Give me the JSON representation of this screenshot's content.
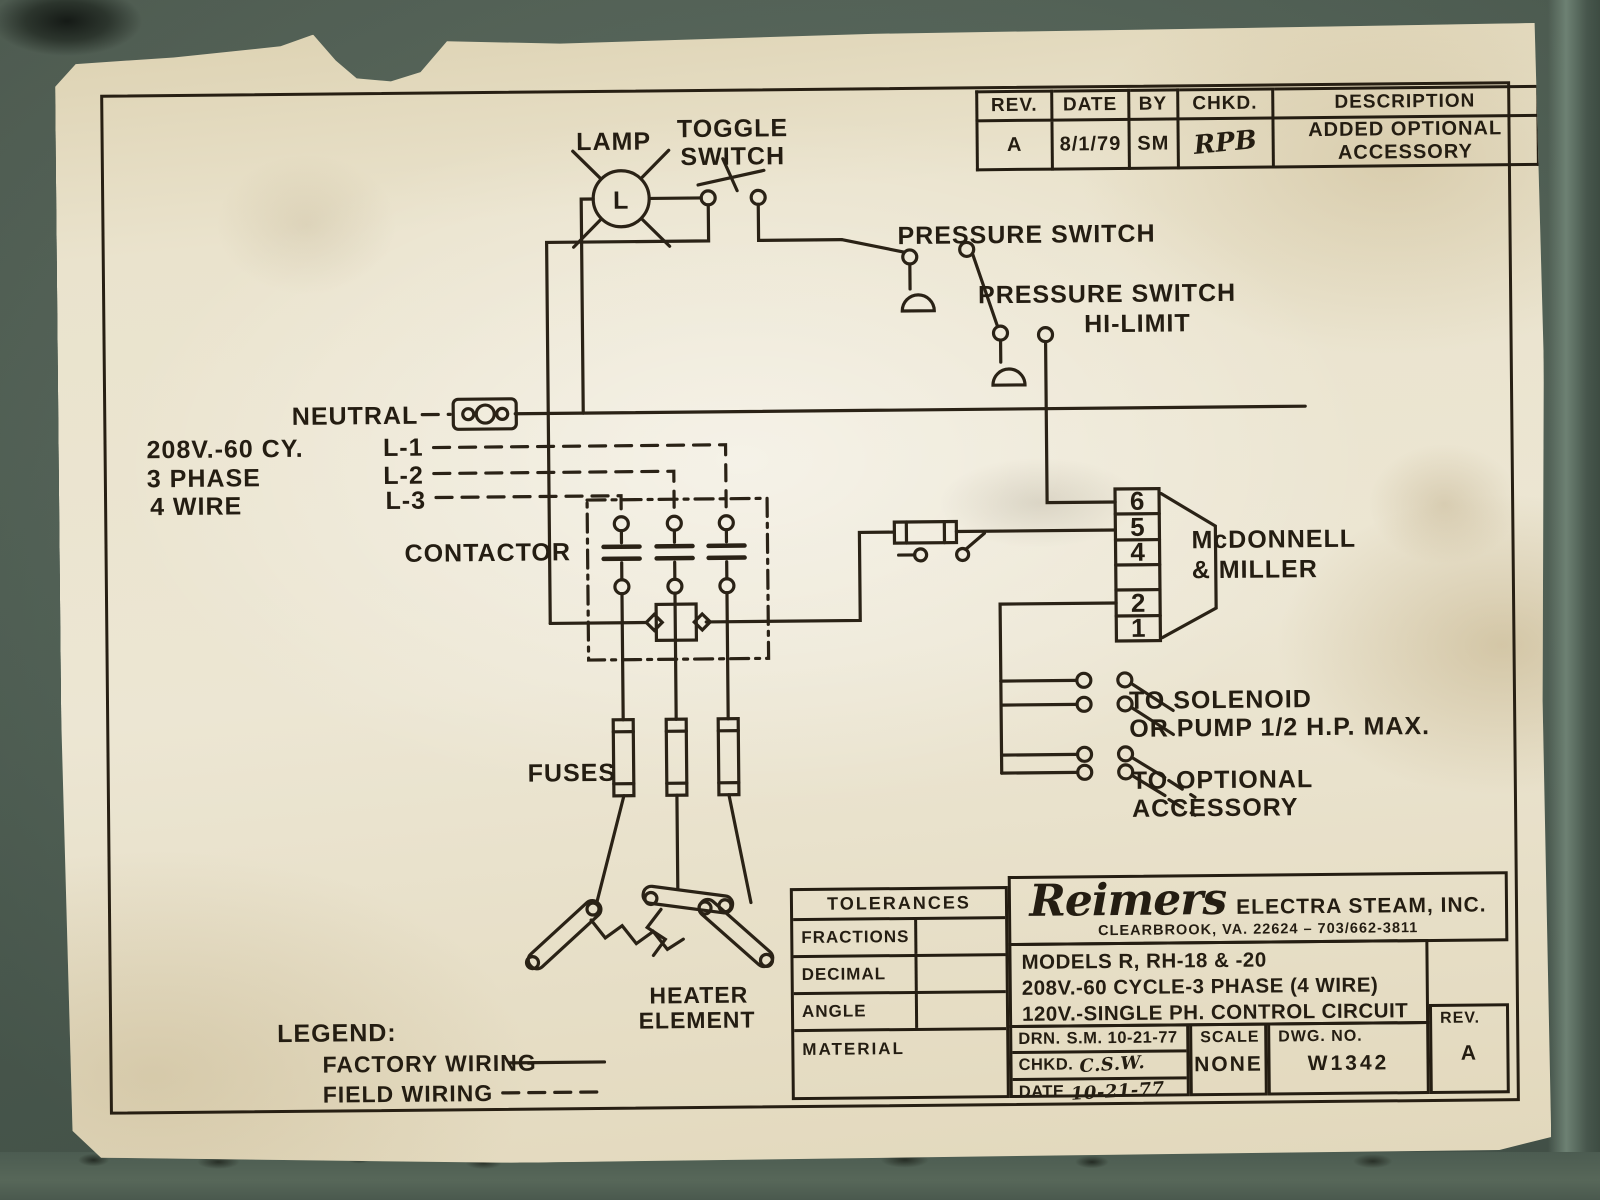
{
  "colors": {
    "background_metal": "#586a5d",
    "paper": "#eae3cd",
    "ink": "#2a2216"
  },
  "revision_table": {
    "headers": [
      "REV.",
      "DATE",
      "BY",
      "CHKD.",
      "DESCRIPTION"
    ],
    "row": {
      "rev": "A",
      "date": "8/1/79",
      "by": "SM",
      "chkd": "RPB",
      "description": "ADDED  OPTIONAL  ACCESSORY"
    }
  },
  "schematic": {
    "lamp_label": "LAMP",
    "lamp_symbol": "L",
    "toggle_switch_line1": "TOGGLE",
    "toggle_switch_line2": "SWITCH",
    "pressure_switch_label": "PRESSURE SWITCH",
    "hi_limit_line1": "PRESSURE SWITCH",
    "hi_limit_line2": "HI-LIMIT",
    "neutral_label": "NEUTRAL",
    "supply_line1": "208V.-60 CY.",
    "supply_line2": "3 PHASE",
    "supply_line3": "4 WIRE",
    "l1_label": "L-1",
    "l2_label": "L-2",
    "l3_label": "L-3",
    "contactor_label": "CONTACTOR",
    "terminal_strip_name_line1": "McDONNELL",
    "terminal_strip_name_line2": "& MILLER",
    "terminal_numbers": [
      "6",
      "5",
      "4",
      "",
      "2",
      "1"
    ],
    "solenoid_line1": "TO SOLENOID",
    "solenoid_line2": "OR PUMP 1/2 H.P. MAX.",
    "accessory_line1": "TO OPTIONAL",
    "accessory_line2": "ACCESSORY",
    "fuses_label": "FUSES",
    "heater_line1": "HEATER",
    "heater_line2": "ELEMENT"
  },
  "legend": {
    "title": "LEGEND:",
    "factory": "FACTORY WIRING",
    "field": "FIELD WIRING"
  },
  "title_block": {
    "tolerances_header": "TOLERANCES",
    "tolerance_rows": [
      "FRACTIONS",
      "DECIMAL",
      "ANGLE"
    ],
    "material_label": "MATERIAL",
    "company_logo": "Reimers",
    "company_name": "ELECTRA STEAM, INC.",
    "company_address": "CLEARBROOK, VA. 22624 – 703/662-3811",
    "model_line1": "MODELS R, RH-18 & -20",
    "model_line2": "208V.-60 CYCLE-3 PHASE (4 WIRE)",
    "model_line3": "120V.-SINGLE PH. CONTROL CIRCUIT",
    "drn_label": "DRN.",
    "drn_value": "S.M. 10-21-77",
    "chkd_label": "CHKD.",
    "chkd_value": "C.S.W.",
    "date_label": "DATE",
    "date_value": "10-21-77",
    "scale_label": "SCALE",
    "scale_value": "NONE",
    "dwg_label": "DWG. NO.",
    "dwg_value": "W1342",
    "rev_label": "REV.",
    "rev_value": "A"
  }
}
